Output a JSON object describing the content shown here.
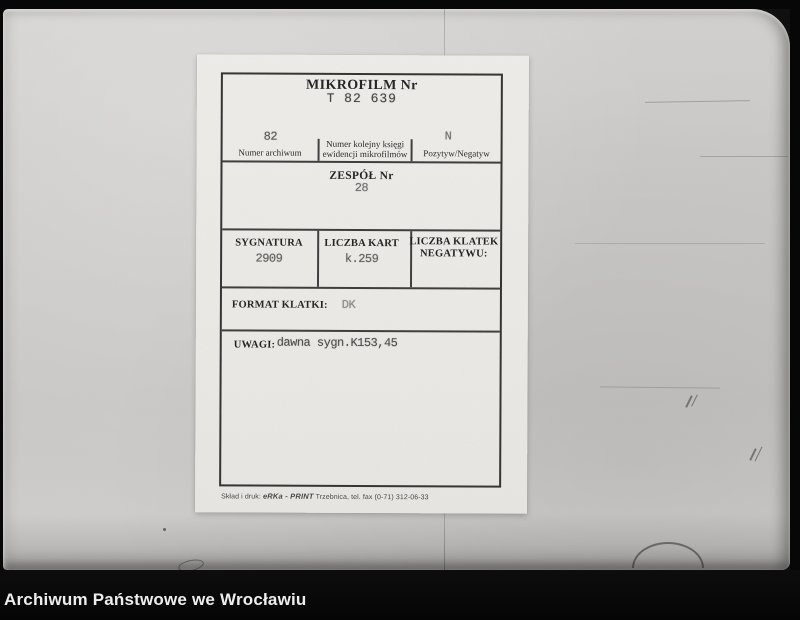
{
  "caption_bar": {
    "text": "Archiwum Państwowe we Wrocławiu"
  },
  "card": {
    "header": {
      "title": "MIKROFILM Nr",
      "number": "T 82 639"
    },
    "registry_row": {
      "archive": {
        "value": "82",
        "label": "Numer archiwum"
      },
      "book": {
        "label_line1": "Numer kolejny księgi",
        "label_line2": "ewidencji mikrofilmów",
        "value": ""
      },
      "polarity": {
        "value": "N",
        "label": "Pozytyw/Negatyw"
      }
    },
    "zespol": {
      "label": "ZESPÓŁ Nr",
      "value": "28"
    },
    "detail_row": {
      "sygnatura": {
        "label": "SYGNATURA",
        "value": "2909"
      },
      "liczba_kart": {
        "label": "LICZBA KART",
        "value": "k.259"
      },
      "liczba_klatek": {
        "label_line1": "LICZBA KLATEK",
        "label_line2": "NEGATYWU:",
        "value": ""
      }
    },
    "format_klatki": {
      "label": "FORMAT KLATKI:",
      "value": "DK"
    },
    "uwagi": {
      "label": "UWAGI:",
      "value": "dawna sygn.K153,45"
    },
    "print_footer": {
      "prefix": "Skład i druk:",
      "brand": "eRKa - PRINT",
      "suffix": "Trzebnica, tel. fax (0-71) 312-06-33"
    }
  },
  "colors": {
    "paper": "#cbcac8",
    "card": "#edebe8",
    "table_border": "#2e2e2e",
    "typed_ink": "#4f4f4f",
    "caption_background": "#070707",
    "caption_text": "#ededed"
  }
}
